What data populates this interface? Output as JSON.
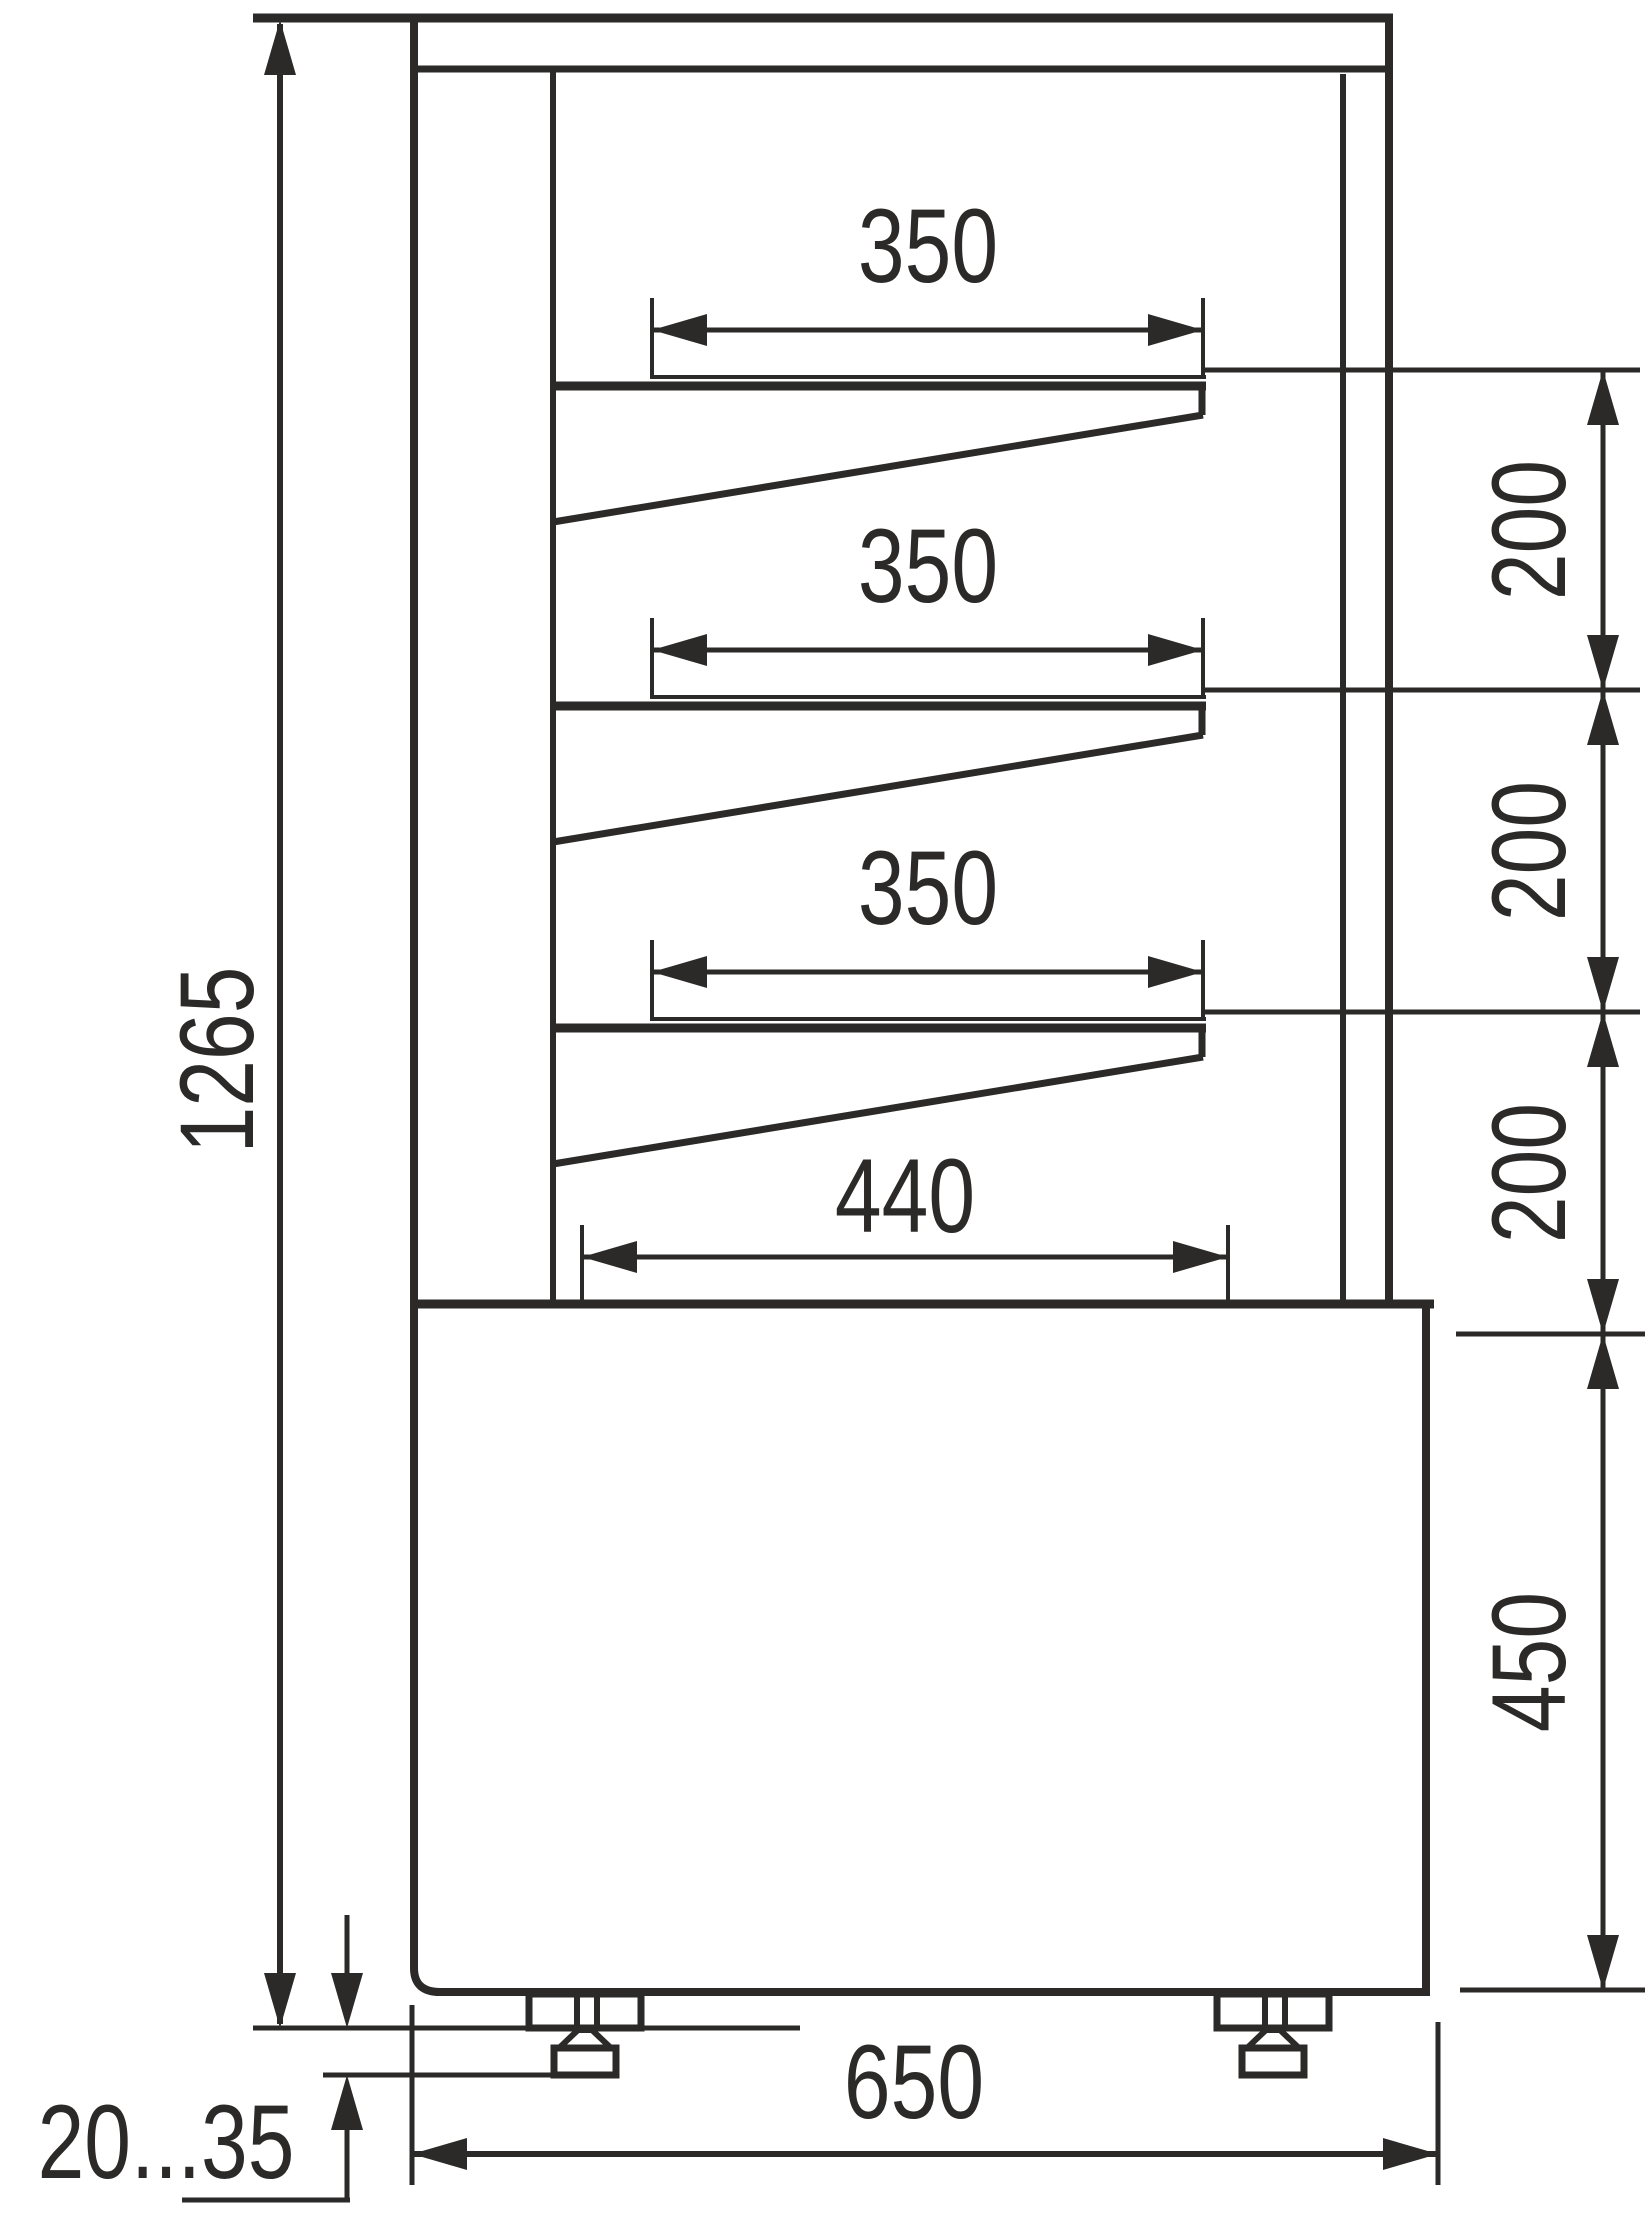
{
  "drawing": {
    "type": "technical-dimension-diagram",
    "subject": "refrigerated display case side section",
    "line_color": "#2b2a29",
    "background_color": "#ffffff",
    "units": "mm",
    "dims": {
      "total_height": "1265",
      "shelf_width": [
        "350",
        "350",
        "350"
      ],
      "deck_width": "440",
      "shelf_gap": [
        "200",
        "200",
        "200"
      ],
      "base_height": "450",
      "overall_depth": "650",
      "foot_adjust_range": "20...35"
    }
  }
}
